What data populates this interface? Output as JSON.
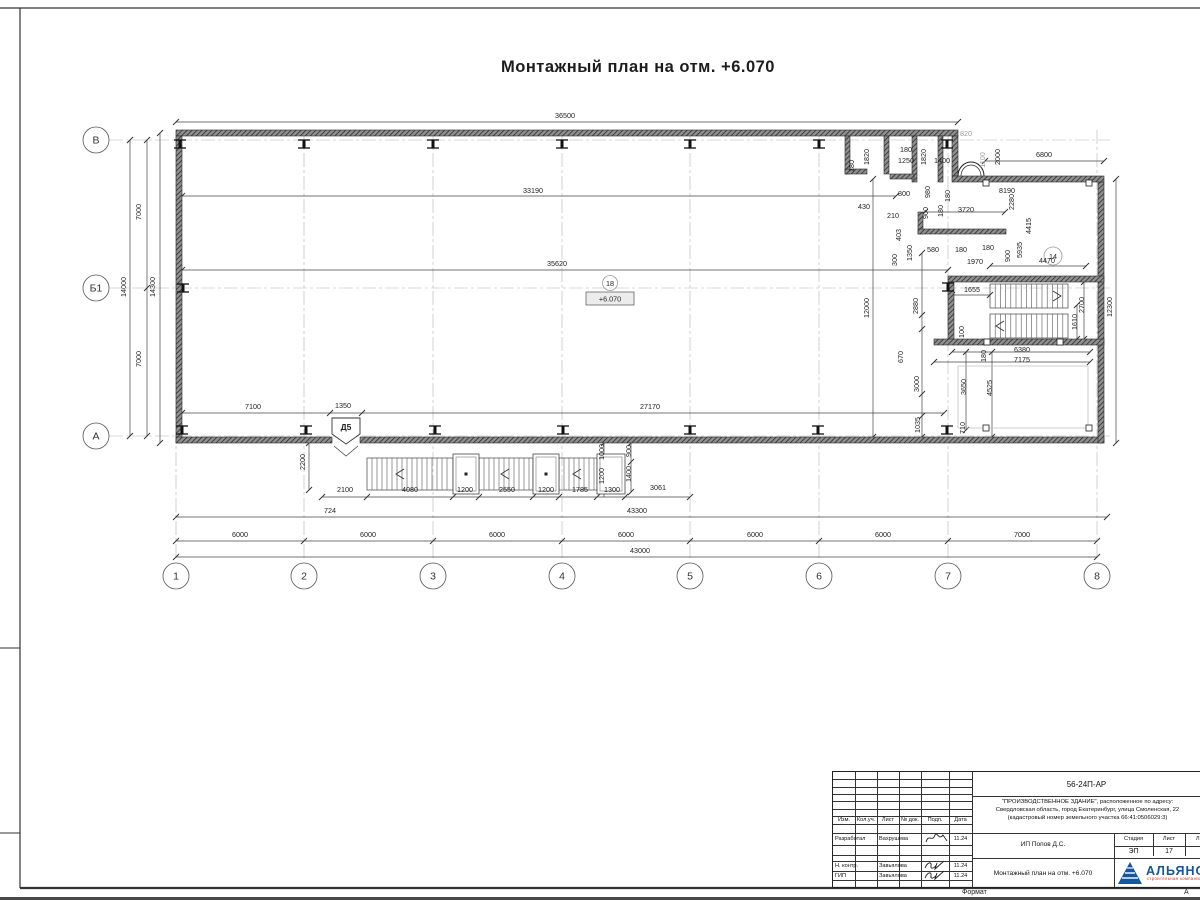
{
  "sheet": {
    "title": "Монтажный план на отм. +6.070",
    "format_label": "Формат",
    "format_value": "А"
  },
  "plan": {
    "level": {
      "circle": "18",
      "value": "+6.070",
      "cx": 610,
      "circle_y": 283,
      "box": [
        586,
        292,
        48,
        13
      ]
    },
    "room": {
      "label": "14",
      "cx": 1053,
      "cy": 256
    },
    "door": {
      "label": "Д5",
      "poly": "332,418 360,418 360,434 346,444 332,434",
      "v": "334,446 346,456 358,446",
      "tx": 346,
      "ty": 430
    },
    "axes_rows": [
      {
        "label": "В",
        "y": 140
      },
      {
        "label": "Б1",
        "y": 288
      },
      {
        "label": "А",
        "y": 436
      }
    ],
    "axes_cols": [
      {
        "label": "1",
        "x": 176
      },
      {
        "label": "2",
        "x": 304
      },
      {
        "label": "3",
        "x": 433
      },
      {
        "label": "4",
        "x": 562
      },
      {
        "label": "5",
        "x": 690
      },
      {
        "label": "6",
        "x": 819
      },
      {
        "label": "7",
        "x": 948
      },
      {
        "label": "8",
        "x": 1097
      }
    ],
    "texts": [
      {
        "t": "36500",
        "x": 565,
        "y": 118
      },
      {
        "t": "33190",
        "x": 533,
        "y": 193
      },
      {
        "t": "35620",
        "x": 557,
        "y": 266
      },
      {
        "t": "7100",
        "x": 253,
        "y": 409
      },
      {
        "t": "1350",
        "x": 343,
        "y": 408
      },
      {
        "t": "27170",
        "x": 650,
        "y": 409
      },
      {
        "t": "6000",
        "x": 240,
        "y": 537
      },
      {
        "t": "6000",
        "x": 368,
        "y": 537
      },
      {
        "t": "6000",
        "x": 497,
        "y": 537
      },
      {
        "t": "6000",
        "x": 626,
        "y": 537
      },
      {
        "t": "6000",
        "x": 755,
        "y": 537
      },
      {
        "t": "6000",
        "x": 883,
        "y": 537
      },
      {
        "t": "7000",
        "x": 1022,
        "y": 537
      },
      {
        "t": "43300",
        "x": 637,
        "y": 513
      },
      {
        "t": "43000",
        "x": 640,
        "y": 553
      },
      {
        "t": "14000",
        "x": 126,
        "y": 287,
        "r": 1
      },
      {
        "t": "14300",
        "x": 155,
        "y": 287,
        "r": 1
      },
      {
        "t": "7000",
        "x": 141,
        "y": 212,
        "r": 1
      },
      {
        "t": "7000",
        "x": 141,
        "y": 359,
        "r": 1
      },
      {
        "t": "12000",
        "x": 869,
        "y": 308,
        "r": 1
      },
      {
        "t": "12300",
        "x": 1112,
        "y": 307,
        "r": 1
      },
      {
        "t": "2200",
        "x": 305,
        "y": 462,
        "r": 1
      },
      {
        "t": "2100",
        "x": 345,
        "y": 492
      },
      {
        "t": "4080",
        "x": 410,
        "y": 492
      },
      {
        "t": "1200",
        "x": 465,
        "y": 492
      },
      {
        "t": "2550",
        "x": 507,
        "y": 492
      },
      {
        "t": "1200",
        "x": 546,
        "y": 492
      },
      {
        "t": "1785",
        "x": 580,
        "y": 492
      },
      {
        "t": "1300",
        "x": 612,
        "y": 492
      },
      {
        "t": "3061",
        "x": 658,
        "y": 490
      },
      {
        "t": "724",
        "x": 330,
        "y": 513
      },
      {
        "t": "1000",
        "x": 604,
        "y": 452,
        "r": 1
      },
      {
        "t": "900",
        "x": 631,
        "y": 451,
        "r": 1
      },
      {
        "t": "1200",
        "x": 604,
        "y": 476,
        "r": 1
      },
      {
        "t": "1400",
        "x": 631,
        "y": 474,
        "r": 1
      },
      {
        "t": "1820",
        "x": 869,
        "y": 157,
        "r": 1
      },
      {
        "t": "180",
        "x": 854,
        "y": 166,
        "r": 1
      },
      {
        "t": "180",
        "x": 906,
        "y": 152
      },
      {
        "t": "1250",
        "x": 906,
        "y": 163
      },
      {
        "t": "1820",
        "x": 926,
        "y": 157,
        "r": 1
      },
      {
        "t": "1400",
        "x": 942,
        "y": 163
      },
      {
        "t": "800",
        "x": 904,
        "y": 196
      },
      {
        "t": "430",
        "x": 864,
        "y": 209
      },
      {
        "t": "210",
        "x": 893,
        "y": 218
      },
      {
        "t": "980",
        "x": 930,
        "y": 192,
        "r": 1
      },
      {
        "t": "900",
        "x": 928,
        "y": 213,
        "r": 1
      },
      {
        "t": "180",
        "x": 943,
        "y": 211,
        "r": 1
      },
      {
        "t": "820",
        "x": 966,
        "y": 136,
        "g": 1
      },
      {
        "t": "1100",
        "x": 985,
        "y": 160,
        "r": 1,
        "g": 1
      },
      {
        "t": "2000",
        "x": 1000,
        "y": 157,
        "r": 1
      },
      {
        "t": "6800",
        "x": 1044,
        "y": 157
      },
      {
        "t": "180",
        "x": 950,
        "y": 196,
        "r": 1
      },
      {
        "t": "8190",
        "x": 1007,
        "y": 193
      },
      {
        "t": "2280",
        "x": 1014,
        "y": 202,
        "r": 1
      },
      {
        "t": "3720",
        "x": 966,
        "y": 212
      },
      {
        "t": "4415",
        "x": 1031,
        "y": 226,
        "r": 1
      },
      {
        "t": "5935",
        "x": 1022,
        "y": 250,
        "r": 1
      },
      {
        "t": "900",
        "x": 1010,
        "y": 256,
        "r": 1
      },
      {
        "t": "180",
        "x": 988,
        "y": 250
      },
      {
        "t": "180",
        "x": 961,
        "y": 252
      },
      {
        "t": "4470",
        "x": 1047,
        "y": 263
      },
      {
        "t": "1970",
        "x": 975,
        "y": 264
      },
      {
        "t": "403",
        "x": 901,
        "y": 235,
        "r": 1
      },
      {
        "t": "1350",
        "x": 912,
        "y": 253,
        "r": 1
      },
      {
        "t": "300",
        "x": 897,
        "y": 260,
        "r": 1
      },
      {
        "t": "580",
        "x": 933,
        "y": 252
      },
      {
        "t": "1655",
        "x": 972,
        "y": 292
      },
      {
        "t": "2880",
        "x": 918,
        "y": 306,
        "r": 1
      },
      {
        "t": "670",
        "x": 903,
        "y": 357,
        "r": 1
      },
      {
        "t": "3000",
        "x": 919,
        "y": 384,
        "r": 1
      },
      {
        "t": "1035",
        "x": 920,
        "y": 425,
        "r": 1
      },
      {
        "t": "100",
        "x": 964,
        "y": 332,
        "r": 1
      },
      {
        "t": "2700",
        "x": 1084,
        "y": 305,
        "r": 1
      },
      {
        "t": "1610",
        "x": 1077,
        "y": 322,
        "r": 1
      },
      {
        "t": "6380",
        "x": 1022,
        "y": 352
      },
      {
        "t": "7175",
        "x": 1022,
        "y": 362
      },
      {
        "t": "180",
        "x": 986,
        "y": 356,
        "r": 1
      },
      {
        "t": "3650",
        "x": 966,
        "y": 387,
        "r": 1
      },
      {
        "t": "4525",
        "x": 992,
        "y": 388,
        "r": 1
      },
      {
        "t": "710",
        "x": 965,
        "y": 428,
        "r": 1
      }
    ],
    "walls": [
      [
        176,
        130,
        782,
        6
      ],
      [
        176,
        136,
        6,
        307
      ],
      [
        176,
        437,
        156,
        6
      ],
      [
        360,
        437,
        744,
        6
      ],
      [
        1098,
        182,
        6,
        261
      ],
      [
        952,
        136,
        6,
        40
      ],
      [
        952,
        176,
        152,
        6
      ],
      [
        845,
        136,
        5,
        38
      ],
      [
        884,
        136,
        5,
        38
      ],
      [
        912,
        136,
        5,
        46
      ],
      [
        938,
        136,
        5,
        46
      ],
      [
        845,
        169,
        22,
        5
      ],
      [
        890,
        174,
        24,
        5
      ],
      [
        918,
        212,
        5,
        22
      ],
      [
        918,
        229,
        88,
        5
      ],
      [
        948,
        276,
        156,
        6
      ],
      [
        948,
        282,
        6,
        62
      ],
      [
        934,
        339,
        170,
        6
      ]
    ],
    "dim_lines": [
      {
        "x1": 176,
        "y1": 122,
        "x2": 958,
        "y2": 122,
        "t": [
          176,
          958
        ]
      },
      {
        "x1": 182,
        "y1": 196,
        "x2": 896,
        "y2": 196,
        "t": [
          182,
          896
        ]
      },
      {
        "x1": 182,
        "y1": 270,
        "x2": 948,
        "y2": 270,
        "t": [
          182,
          948
        ]
      },
      {
        "x1": 985,
        "y1": 161,
        "x2": 1104,
        "y2": 161,
        "t": [
          985,
          1104
        ]
      },
      {
        "x1": 182,
        "y1": 413,
        "x2": 944,
        "y2": 413,
        "t": [
          182,
          330,
          362,
          944
        ]
      },
      {
        "x1": 322,
        "y1": 497,
        "x2": 690,
        "y2": 497,
        "t": [
          322,
          367,
          453,
          479,
          533,
          559,
          597,
          625,
          690
        ]
      },
      {
        "x1": 176,
        "y1": 517,
        "x2": 1107,
        "y2": 517,
        "t": [
          176,
          1107
        ]
      },
      {
        "x1": 176,
        "y1": 541,
        "x2": 1097,
        "y2": 541,
        "t": [
          176,
          304,
          433,
          562,
          690,
          819,
          948,
          1097
        ]
      },
      {
        "x1": 176,
        "y1": 557,
        "x2": 1097,
        "y2": 557,
        "t": [
          176,
          1097
        ]
      },
      {
        "x1": 147,
        "y1": 140,
        "x2": 147,
        "y2": 436,
        "t": [
          140,
          288,
          436
        ]
      },
      {
        "x1": 130,
        "y1": 140,
        "x2": 130,
        "y2": 436,
        "t": [
          140,
          436
        ]
      },
      {
        "x1": 160,
        "y1": 133,
        "x2": 160,
        "y2": 443,
        "t": [
          133,
          443
        ]
      },
      {
        "x1": 873,
        "y1": 179,
        "x2": 873,
        "y2": 437,
        "t": [
          179,
          437
        ]
      },
      {
        "x1": 1116,
        "y1": 179,
        "x2": 1116,
        "y2": 443,
        "t": [
          179,
          443
        ]
      },
      {
        "x1": 922,
        "y1": 253,
        "x2": 922,
        "y2": 437,
        "t": [
          253,
          315,
          329,
          394,
          416,
          437
        ]
      },
      {
        "x1": 309,
        "y1": 443,
        "x2": 309,
        "y2": 490,
        "t": [
          443,
          490
        ]
      },
      {
        "x1": 604,
        "y1": 443,
        "x2": 604,
        "y2": 497,
        "t": [
          443,
          464,
          490
        ]
      },
      {
        "x1": 631,
        "y1": 443,
        "x2": 631,
        "y2": 492,
        "t": [
          443,
          462,
          492
        ]
      },
      {
        "x1": 952,
        "y1": 352,
        "x2": 1090,
        "y2": 352,
        "t": [
          952,
          1090
        ]
      },
      {
        "x1": 934,
        "y1": 362,
        "x2": 1090,
        "y2": 362,
        "t": [
          934,
          1090
        ]
      },
      {
        "x1": 966,
        "y1": 352,
        "x2": 966,
        "y2": 430,
        "t": [
          352,
          430
        ]
      },
      {
        "x1": 992,
        "y1": 352,
        "x2": 992,
        "y2": 437,
        "t": [
          352,
          437
        ]
      },
      {
        "x1": 1084,
        "y1": 282,
        "x2": 1084,
        "y2": 339,
        "t": [
          282,
          339
        ]
      },
      {
        "x1": 1077,
        "y1": 305,
        "x2": 1077,
        "y2": 339,
        "t": [
          305,
          339
        ]
      },
      {
        "x1": 925,
        "y1": 212,
        "x2": 1005,
        "y2": 212,
        "t": [
          925,
          1005
        ]
      },
      {
        "x1": 990,
        "y1": 266,
        "x2": 1086,
        "y2": 266,
        "t": [
          990,
          1086
        ]
      },
      {
        "x1": 952,
        "y1": 295,
        "x2": 990,
        "y2": 295,
        "t": [
          952,
          990
        ]
      }
    ],
    "beams_top": [
      180,
      304,
      433,
      562,
      690,
      819,
      947
    ],
    "beams_bottom": [
      182,
      306,
      435,
      563,
      690,
      818,
      947
    ],
    "beams_other": [
      [
        183,
        288
      ],
      [
        948,
        287
      ]
    ],
    "flights": [
      {
        "x": 367,
        "y": 458,
        "w": 86,
        "h": 32,
        "s": 5
      },
      {
        "x": 479,
        "y": 458,
        "w": 54,
        "h": 32,
        "s": 5
      },
      {
        "x": 559,
        "y": 458,
        "w": 38,
        "h": 32,
        "s": 5
      },
      {
        "x": 990,
        "y": 284,
        "w": 78,
        "h": 24,
        "s": 5.2
      },
      {
        "x": 990,
        "y": 314,
        "w": 78,
        "h": 24,
        "s": 5.2
      }
    ],
    "landings": [
      [
        453,
        454,
        26,
        40
      ],
      [
        533,
        454,
        26,
        40
      ],
      [
        597,
        454,
        28,
        40
      ]
    ],
    "dots": [
      [
        466,
        474
      ],
      [
        546,
        474
      ]
    ],
    "chevrons": [
      [
        400,
        474,
        "l"
      ],
      [
        505,
        474,
        "l"
      ],
      [
        577,
        474,
        "l"
      ],
      [
        1057,
        296,
        "r"
      ],
      [
        1000,
        326,
        "l"
      ]
    ],
    "squares": [
      [
        986,
        183
      ],
      [
        1089,
        183
      ],
      [
        986,
        428
      ],
      [
        1089,
        428
      ],
      [
        987,
        342
      ],
      [
        1060,
        342
      ]
    ],
    "inner_rect": [
      958,
      366,
      130,
      62
    ]
  },
  "titleblock": {
    "doc_number": "56-24П-АР",
    "project_line1": "\"ПРОИЗВОДСТВЕННОЕ ЗДАНИЕ\", расположенное по адресу:",
    "project_line2": "Свердловская область, город Екатеринбург, улица Смоленская, 22",
    "project_line3": "(кадастровый номер земельного участка 66:41:0506029:3)",
    "client": "ИП Попов Д.С.",
    "sheet_title": "Монтажный план на отм. +6.070",
    "cols": [
      "Изм.",
      "Кол.уч.",
      "Лист",
      "№ док.",
      "Подп.",
      "Дата"
    ],
    "rows": [
      {
        "role": "Разработал",
        "name": "Вахрушева",
        "date": "11.24"
      },
      {
        "role": "Н. контр.",
        "name": "Завьялова",
        "date": "11.24"
      },
      {
        "role": "ГИП",
        "name": "Завьялова",
        "date": "11.24"
      }
    ],
    "stage_label": "Стадия",
    "stage": "ЭП",
    "sheet_label": "Лист",
    "sheet_num": "17",
    "sheets_label": "Листов",
    "sheets_num": "2",
    "company": "АЛЬЯНС",
    "company_sub": "строительная компания"
  }
}
